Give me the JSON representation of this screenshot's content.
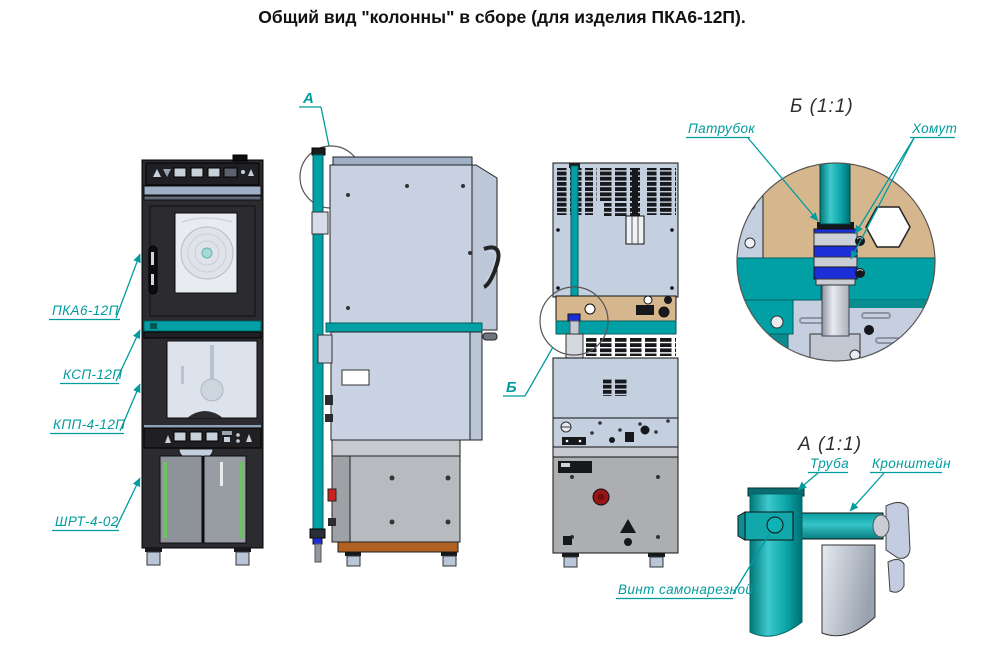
{
  "title": "Общий вид \"колонны\" в сборе (для изделия ПКА6-12П).",
  "views": {
    "front": {
      "callouts": [
        {
          "label": "ПКА6-12П"
        },
        {
          "label": "КСП-12П"
        },
        {
          "label": "КПП-4-12П"
        },
        {
          "label": "ШРТ-4-02"
        }
      ]
    },
    "side": {
      "marker": "А"
    },
    "back": {
      "marker": "Б"
    }
  },
  "details": {
    "b": {
      "title": "Б (1:1)",
      "callouts": [
        {
          "label": "Патрубок"
        },
        {
          "label": "Хомут"
        }
      ]
    },
    "a": {
      "title": "А (1:1)",
      "callouts": [
        {
          "label": "Труба"
        },
        {
          "label": "Кронштейн"
        },
        {
          "label": "Винт самонарезной"
        }
      ]
    }
  },
  "colors": {
    "accent_teal": "#00A0A4",
    "label_teal": "#009C9E",
    "panel_blue": "#C5CFE0",
    "panel_gray": "#B5B8BC",
    "tan": "#D6B78D",
    "dark_body": "#2B2B30",
    "clamp_blue": "#1C2FD6",
    "brown_strip": "#B06020",
    "red_button": "#991515",
    "feet_blue": "#B9C6D8"
  }
}
